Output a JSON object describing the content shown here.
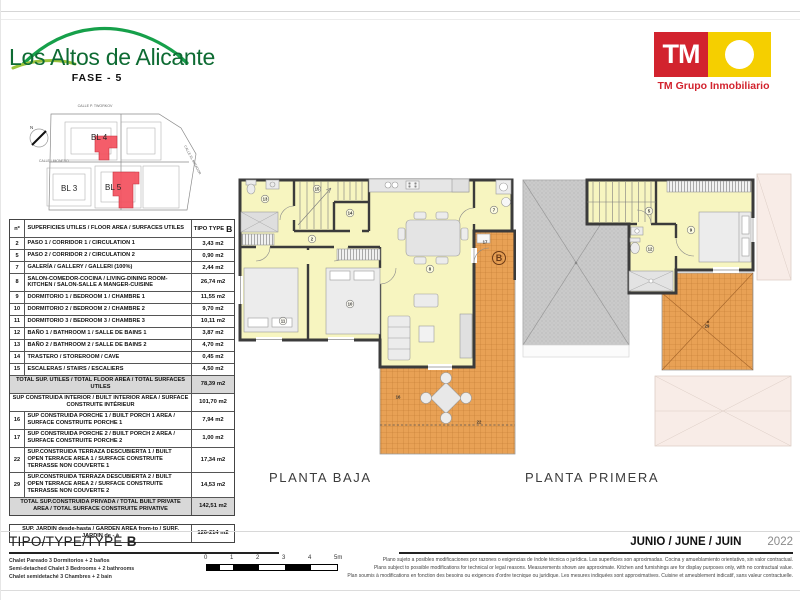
{
  "header": {
    "project_title": "Los Altos de Alicante",
    "phase": "FASE - 5",
    "brand": {
      "tm": "TM",
      "name": "TM Grupo Inmobiliario"
    }
  },
  "site_plan": {
    "streets": [
      "CALLE P. TWORKOV",
      "CALLE LIMONERO",
      "CALLE EL MIRADOR"
    ],
    "north": "N",
    "blocks": [
      {
        "label": "BL 4",
        "x": 70,
        "y": 42
      },
      {
        "label": "BL 3",
        "x": 40,
        "y": 93
      },
      {
        "label": "BL 5",
        "x": 84,
        "y": 92
      }
    ]
  },
  "table": {
    "col_no": "nº",
    "col_desc": "SUPERFICIES UTILES / FLOOR AREA / SURFACES UTILES",
    "col_type": "TIPO TYPE",
    "type_letter": "B",
    "rows": [
      {
        "no": "2",
        "desc": "PASO 1 / CORRIDOR 1 / CIRCULATION 1",
        "value": "3,43 m2"
      },
      {
        "no": "5",
        "desc": "PASO 2 / CORRIDOR 2 / CIRCULATION 2",
        "value": "0,90 m2"
      },
      {
        "no": "7",
        "desc": "GALERÍA / GALLERY / GALLERI (100%)",
        "value": "2,44 m2"
      },
      {
        "no": "8",
        "desc": "SALON-COMEDOR-COCINA /  LIVING-DINING ROOM-KITCHEN / SALON-SALLE A MANGER-CUISINE",
        "value": "26,74 m2"
      },
      {
        "no": "9",
        "desc": "DORMITORIO 1 / BEDROOM 1 / CHAMBRE 1",
        "value": "11,55 m2"
      },
      {
        "no": "10",
        "desc": "DORMITORIO 2 / BEDROOM 2 / CHAMBRE 2",
        "value": "9,70 m2"
      },
      {
        "no": "11",
        "desc": "DORMITORIO 3 / BEDROOM 3 / CHAMBRE 3",
        "value": "10,11 m2"
      },
      {
        "no": "12",
        "desc": "BAÑO 1 / BATHROOM 1 / SALLE DE BAINS 1",
        "value": "3,87 m2"
      },
      {
        "no": "13",
        "desc": "BAÑO 2 / BATHROOM 2 / SALLE DE BAINS 2",
        "value": "4,70 m2"
      },
      {
        "no": "14",
        "desc": "TRASTERO / STOREROOM / CAVE",
        "value": "0,45 m2"
      },
      {
        "no": "15",
        "desc": "ESCALERAS / STAIRS / ESCALIERS",
        "value": "4,50 m2"
      },
      {
        "kind": "total",
        "desc": "TOTAL SUP. UTILES / TOTAL FLOOR AREA / TOTAL SURFACES UTILES",
        "value": "78,39 m2"
      },
      {
        "kind": "span",
        "desc": "SUP CONSTRUIDA INTERIOR / BUILT INTERIOR AREA / SURFACE CONSTRUITE INTÉRIEUR",
        "value": "101,70 m2"
      },
      {
        "no": "16",
        "desc": "SUP CONSTRUIDA PORCHE 1 / BUILT PORCH 1 AREA / SURFACE CONSTRUITE PORCHE 1",
        "value": "7,94 m2"
      },
      {
        "no": "17",
        "desc": "SUP CONSTRUIDA PORCHE 2 / BUILT PORCH 2 AREA / SURFACE CONSTRUITE PORCHE 2",
        "value": "1,00 m2"
      },
      {
        "no": "22",
        "desc": "SUP.CONSTRUIDA TERRAZA DESCUBIERTA 1 / BUILT OPEN TERRACE AREA 1 /  SURFACE CONSTRUITE TERRASSE NON COUVERTE 1",
        "value": "17,34 m2"
      },
      {
        "no": "29",
        "desc": "SUP.CONSTRUIDA TERRAZA DESCUBIERTA 2 / BUILT OPEN TERRACE AREA 2 /  SURFACE CONSTRUITE TERRASSE NON COUVERTE 2",
        "value": "14,53 m2"
      },
      {
        "kind": "total",
        "desc": "TOTAL SUP.CONSTRUIDA PRIVADA / TOTAL  BUILT PRIVATE AREA / TOTAL SURFACE CONSTRUITE PRIVATIVE",
        "value": "142,51 m2"
      }
    ],
    "jardin": {
      "desc": "SUP. JARDIN desde-hasta / GARDEN AREA from-to / SURF. JARDIN  de - à",
      "value": "126-214 m2"
    }
  },
  "plans": {
    "baja": {
      "caption": "PLANTA BAJA",
      "labels": [
        {
          "t": "13",
          "x": 27,
          "y": 31
        },
        {
          "t": "15",
          "x": 79,
          "y": 21
        },
        {
          "t": "14",
          "x": 112,
          "y": 45
        },
        {
          "t": "2",
          "x": 74,
          "y": 71
        },
        {
          "t": "7",
          "x": 256,
          "y": 42
        },
        {
          "t": "8",
          "x": 192,
          "y": 101
        },
        {
          "t": "10",
          "x": 112,
          "y": 136
        },
        {
          "t": "11",
          "x": 45,
          "y": 153
        },
        {
          "t": "17",
          "x": 247,
          "y": 74,
          "plain": true
        },
        {
          "t": "16",
          "x": 160,
          "y": 229,
          "plain": true
        },
        {
          "t": "22",
          "x": 241,
          "y": 254,
          "plain": true
        }
      ],
      "type_label": {
        "t": "B",
        "x": 261,
        "y": 90
      }
    },
    "primera": {
      "caption": "PLANTA PRIMERA",
      "labels": [
        {
          "t": "5",
          "x": 128,
          "y": 43
        },
        {
          "t": "9",
          "x": 170,
          "y": 62
        },
        {
          "t": "12",
          "x": 129,
          "y": 81
        },
        {
          "t": "29",
          "x": 186,
          "y": 158,
          "plain": true
        }
      ]
    }
  },
  "footer": {
    "type_title": "TIPO/TYPE/TYPE",
    "type_letter": "B",
    "chalet_es": "Chalet Pareado 3 Dormitorios + 2 baños",
    "chalet_en": "Semi-detached Chalet 3 Bedrooms + 2 bathrooms",
    "chalet_fr": "Chalet semidetaché 3 Chambres + 2 bain",
    "scale_ticks": [
      "0",
      "1",
      "2",
      "3",
      "4",
      "5m"
    ],
    "date": "JUNIO / JUNE / JUIN",
    "year": "2022",
    "disclaimer_es": "Plano sujeto a posibles modificaciones por razones o exigencias de índole técnica o jurídica. Las superficies son aproximadas. Cocina y amueblamiento orientativo, sin valor contractual.",
    "disclaimer_en": "Plans subject to possible modifications for technical or legal reasons. Measurements shown are approximate. Kitchen and furnishings are for display purposes only, with no contractual value.",
    "disclaimer_fr": "Plan soumis à modifications en fonction des besoins ou exigences d'ordre tecnique ou juridique. Les mesures indiquées sont approximatives. Cuisine et ameublement indicatif, sans valeur contractuelle."
  },
  "colors": {
    "brand_green": "#0e6b33",
    "tm_red": "#d2232e",
    "tm_yellow": "#f5cf00",
    "room_yellow": "#f7f5c0",
    "terrace_orange": "#e8a155",
    "highlight_red": "#f4505e"
  }
}
